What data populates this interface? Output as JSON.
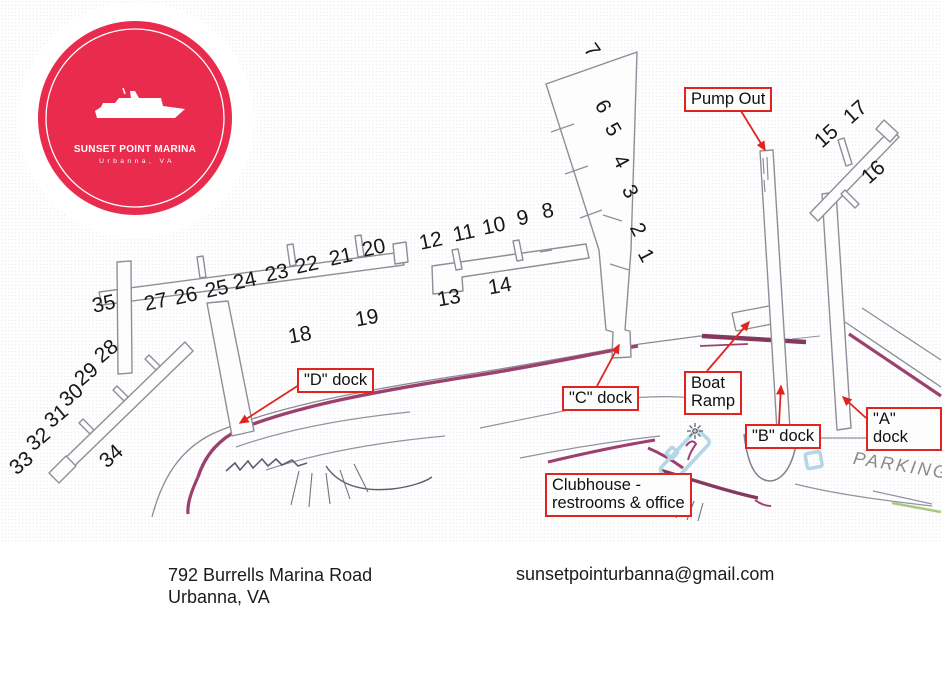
{
  "colors": {
    "logo_red": "#e92c4e",
    "label_red": "#e02520",
    "dock_gray": "#8e8e98",
    "shore_maroon": "#9c4070",
    "shore_maroon_dark": "#83395e",
    "building_blue": "#b5d6e6",
    "rock_gray": "#57606e",
    "parking_gray": "#8a8a8a",
    "green_accent": "#a9c87d"
  },
  "logo": {
    "title": "SUNSET POINT MARINA",
    "subtitle": "Urbanna, VA"
  },
  "footer": {
    "address_line1": "792 Burrells Marina Road",
    "address_line2": "Urbanna, VA",
    "email": "sunsetpointurbanna@gmail.com"
  },
  "map": {
    "parking_label": "PARKING",
    "slip_numbers": [
      {
        "n": "1",
        "x": 645,
        "y": 256,
        "r": 62
      },
      {
        "n": "2",
        "x": 637,
        "y": 230,
        "r": 62
      },
      {
        "n": "3",
        "x": 629,
        "y": 192,
        "r": 62
      },
      {
        "n": "4",
        "x": 620,
        "y": 162,
        "r": 62
      },
      {
        "n": "5",
        "x": 612,
        "y": 130,
        "r": 60
      },
      {
        "n": "6",
        "x": 602,
        "y": 107,
        "r": 60
      },
      {
        "n": "7",
        "x": 591,
        "y": 51,
        "r": 55
      },
      {
        "n": "8",
        "x": 548,
        "y": 212,
        "r": -12
      },
      {
        "n": "9",
        "x": 523,
        "y": 219,
        "r": -12
      },
      {
        "n": "10",
        "x": 494,
        "y": 227,
        "r": -12
      },
      {
        "n": "11",
        "x": 464,
        "y": 234,
        "r": -12
      },
      {
        "n": "12",
        "x": 431,
        "y": 242,
        "r": -12
      },
      {
        "n": "13",
        "x": 449,
        "y": 299,
        "r": -10
      },
      {
        "n": "14",
        "x": 500,
        "y": 287,
        "r": -10
      },
      {
        "n": "15",
        "x": 827,
        "y": 137,
        "r": -42
      },
      {
        "n": "16",
        "x": 874,
        "y": 173,
        "r": -42
      },
      {
        "n": "17",
        "x": 856,
        "y": 113,
        "r": -42
      },
      {
        "n": "18",
        "x": 300,
        "y": 336,
        "r": -10
      },
      {
        "n": "19",
        "x": 367,
        "y": 319,
        "r": -10
      },
      {
        "n": "20",
        "x": 374,
        "y": 249,
        "r": -12
      },
      {
        "n": "21",
        "x": 341,
        "y": 258,
        "r": -12
      },
      {
        "n": "22",
        "x": 307,
        "y": 266,
        "r": -12
      },
      {
        "n": "23",
        "x": 277,
        "y": 274,
        "r": -12
      },
      {
        "n": "24",
        "x": 245,
        "y": 282,
        "r": -12
      },
      {
        "n": "25",
        "x": 217,
        "y": 290,
        "r": -12
      },
      {
        "n": "26",
        "x": 186,
        "y": 297,
        "r": -12
      },
      {
        "n": "27",
        "x": 156,
        "y": 303,
        "r": -12
      },
      {
        "n": "28",
        "x": 107,
        "y": 352,
        "r": -40
      },
      {
        "n": "29",
        "x": 87,
        "y": 375,
        "r": -40
      },
      {
        "n": "30",
        "x": 72,
        "y": 396,
        "r": -40
      },
      {
        "n": "31",
        "x": 57,
        "y": 417,
        "r": -40
      },
      {
        "n": "32",
        "x": 39,
        "y": 440,
        "r": -40
      },
      {
        "n": "33",
        "x": 22,
        "y": 464,
        "r": -40
      },
      {
        "n": "34",
        "x": 112,
        "y": 457,
        "r": -42
      },
      {
        "n": "35",
        "x": 104,
        "y": 305,
        "r": -12
      }
    ],
    "labels": [
      {
        "id": "pump-out",
        "text": "Pump Out",
        "x": 684,
        "y": 87,
        "arrow": [
          741,
          111,
          765,
          150
        ]
      },
      {
        "id": "d-dock",
        "text": "\"D\" dock",
        "x": 297,
        "y": 368,
        "arrow": [
          299,
          385,
          240,
          423
        ]
      },
      {
        "id": "c-dock",
        "text": "\"C\" dock",
        "x": 562,
        "y": 386,
        "arrow": [
          597,
          386,
          619,
          345
        ]
      },
      {
        "id": "boat-ramp",
        "text": "Boat\nRamp",
        "x": 684,
        "y": 371,
        "arrow": [
          707,
          371,
          749,
          322
        ]
      },
      {
        "id": "b-dock",
        "text": "\"B\" dock",
        "x": 745,
        "y": 424,
        "arrow": [
          779,
          424,
          781,
          386
        ]
      },
      {
        "id": "a-dock",
        "text": "\"A\" dock",
        "x": 866,
        "y": 407,
        "arrow": [
          866,
          418,
          843,
          397
        ]
      },
      {
        "id": "clubhouse",
        "text": "Clubhouse -\nrestrooms & office",
        "x": 545,
        "y": 473,
        "arrow": null
      }
    ]
  }
}
